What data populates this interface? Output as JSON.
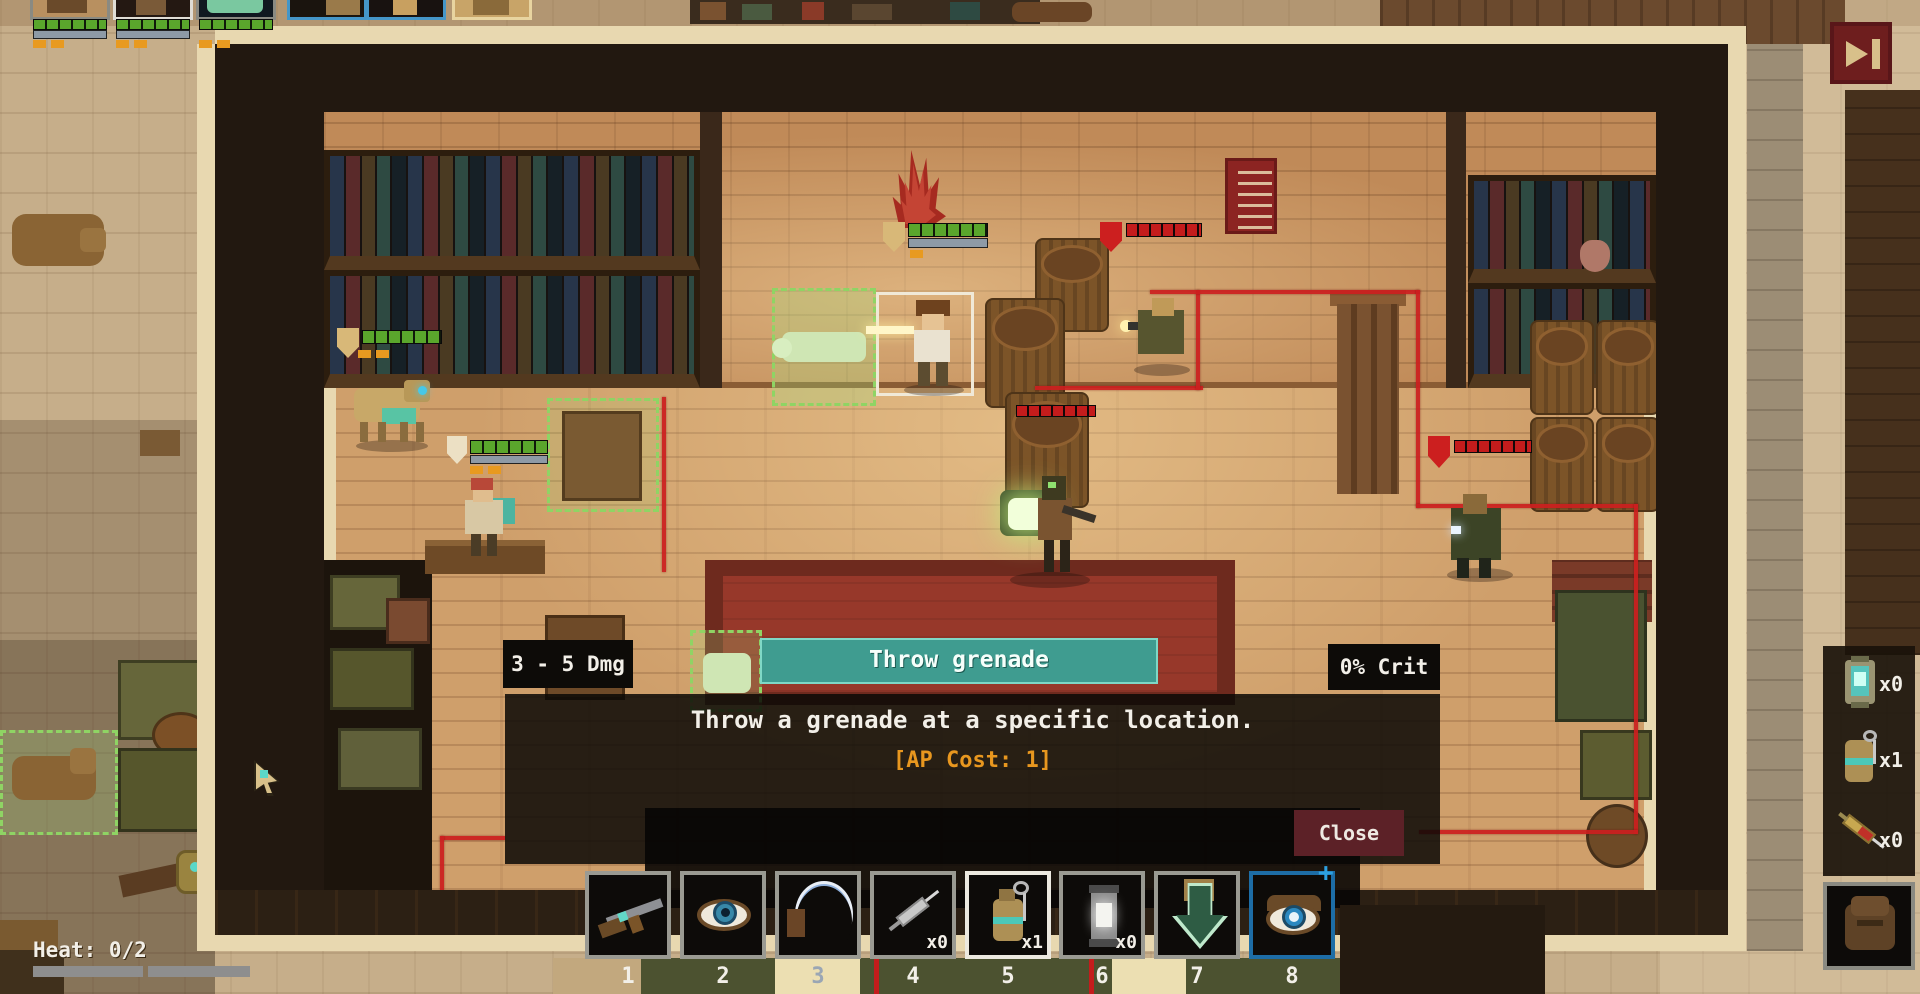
{
  "tooltip": {
    "damage": "3 - 5 Dmg",
    "title": "Throw grenade",
    "crit": "0% Crit",
    "description": "Throw a grenade at a specific location.",
    "ap_cost": "[AP Cost: 1]",
    "close_label": "Close"
  },
  "heat": {
    "label": "Heat: 0/2",
    "segments": 2
  },
  "hotbar": {
    "slots": [
      {
        "number": "1",
        "icon": "rifle-icon",
        "count": ""
      },
      {
        "number": "2",
        "icon": "eye-icon",
        "count": ""
      },
      {
        "number": "3",
        "icon": "wave-dash-icon",
        "count": ""
      },
      {
        "number": "4",
        "icon": "syringe-icon",
        "count": "x0"
      },
      {
        "number": "5",
        "icon": "grenade-icon",
        "count": "x1",
        "selected": true
      },
      {
        "number": "6",
        "icon": "lantern-icon",
        "count": "x0"
      },
      {
        "number": "7",
        "icon": "reload-arrow-icon",
        "count": ""
      },
      {
        "number": "8",
        "icon": "eye-plus-icon",
        "count": "",
        "plus": "+"
      }
    ]
  },
  "inventory": {
    "items": [
      {
        "icon": "stun-lantern-icon",
        "count": "x0"
      },
      {
        "icon": "frag-grenade-icon",
        "count": "x1"
      },
      {
        "icon": "stim-syringe-icon",
        "count": "x0"
      }
    ],
    "bag_icon": "satchel-icon"
  },
  "top_bar": {
    "skip_icon": "skip-turn-icon",
    "party_portraits": 6
  },
  "colors": {
    "teal_header": "#3f9c90",
    "ap_orange": "#e8971f",
    "close_red": "#5c2127",
    "hp_green": "#5aa62c",
    "enemy_red": "#c41c1c",
    "selected_slot_blue": "#1d6da6"
  }
}
